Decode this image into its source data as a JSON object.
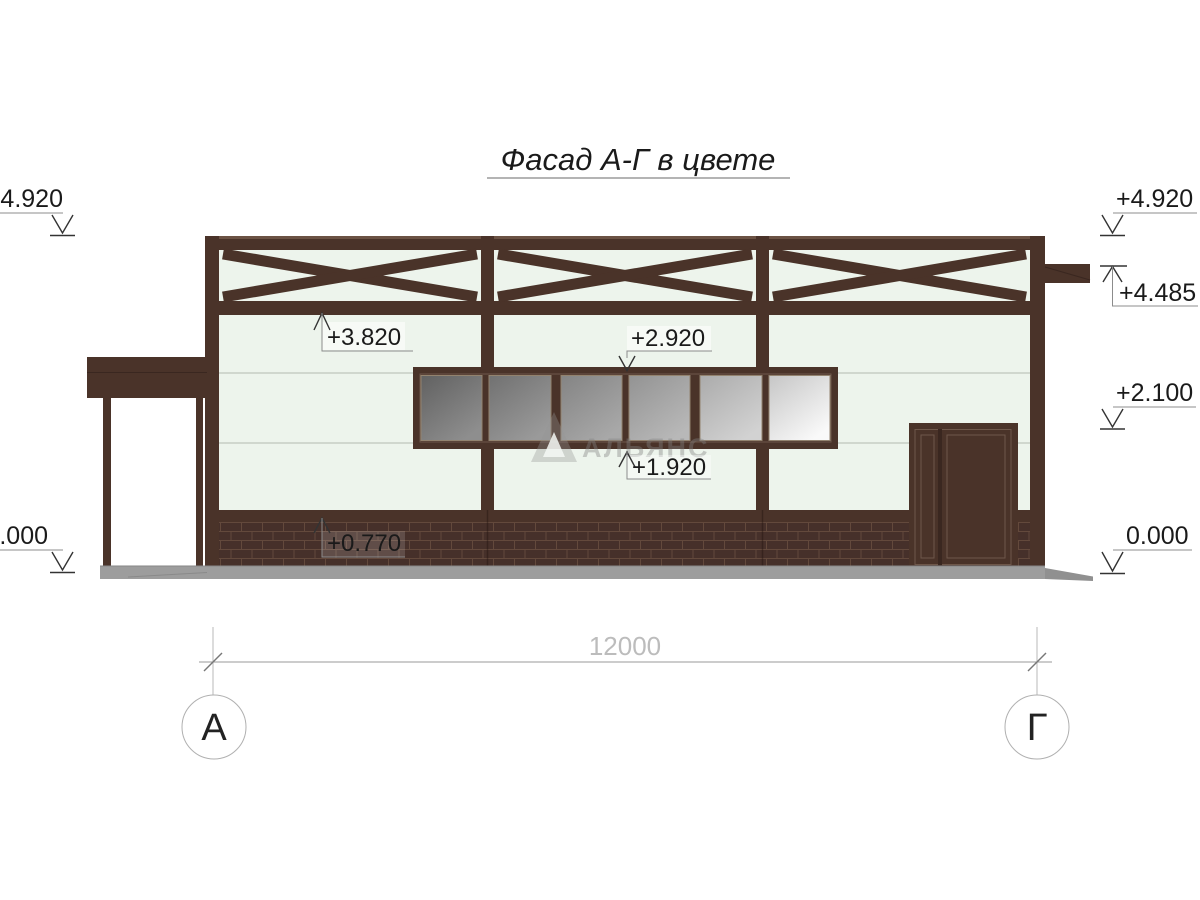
{
  "title": {
    "text": "Фасад А-Г в цвете"
  },
  "watermark": {
    "text": "АЛЬЯНС",
    "logo": "triangle-logo"
  },
  "marks": {
    "left_top": "+4.920",
    "left_zero": "0.000",
    "right_top": "+4.920",
    "right_beam": "+4.485",
    "right_door": "+2.100",
    "right_zero": "0.000",
    "beam_bottom": "+3.820",
    "window_top": "+2.920",
    "window_bottom": "+1.920",
    "brick_top": "+0.770"
  },
  "dimension": {
    "total": "12000"
  },
  "axes": {
    "left": "А",
    "right": "Г"
  },
  "colors": {
    "frame_brown": "#4a3329",
    "frame_brown_dark": "#3a2720",
    "frame_highlight": "#6b5244",
    "wall_mint": "#edf4ec",
    "brick_mortar": "#63493c",
    "plinth_gray": "#9d9d9d",
    "glass_dark": "#656565",
    "glass_light": "#f5f5f5",
    "annotation_gray": "#8c8c8c"
  }
}
